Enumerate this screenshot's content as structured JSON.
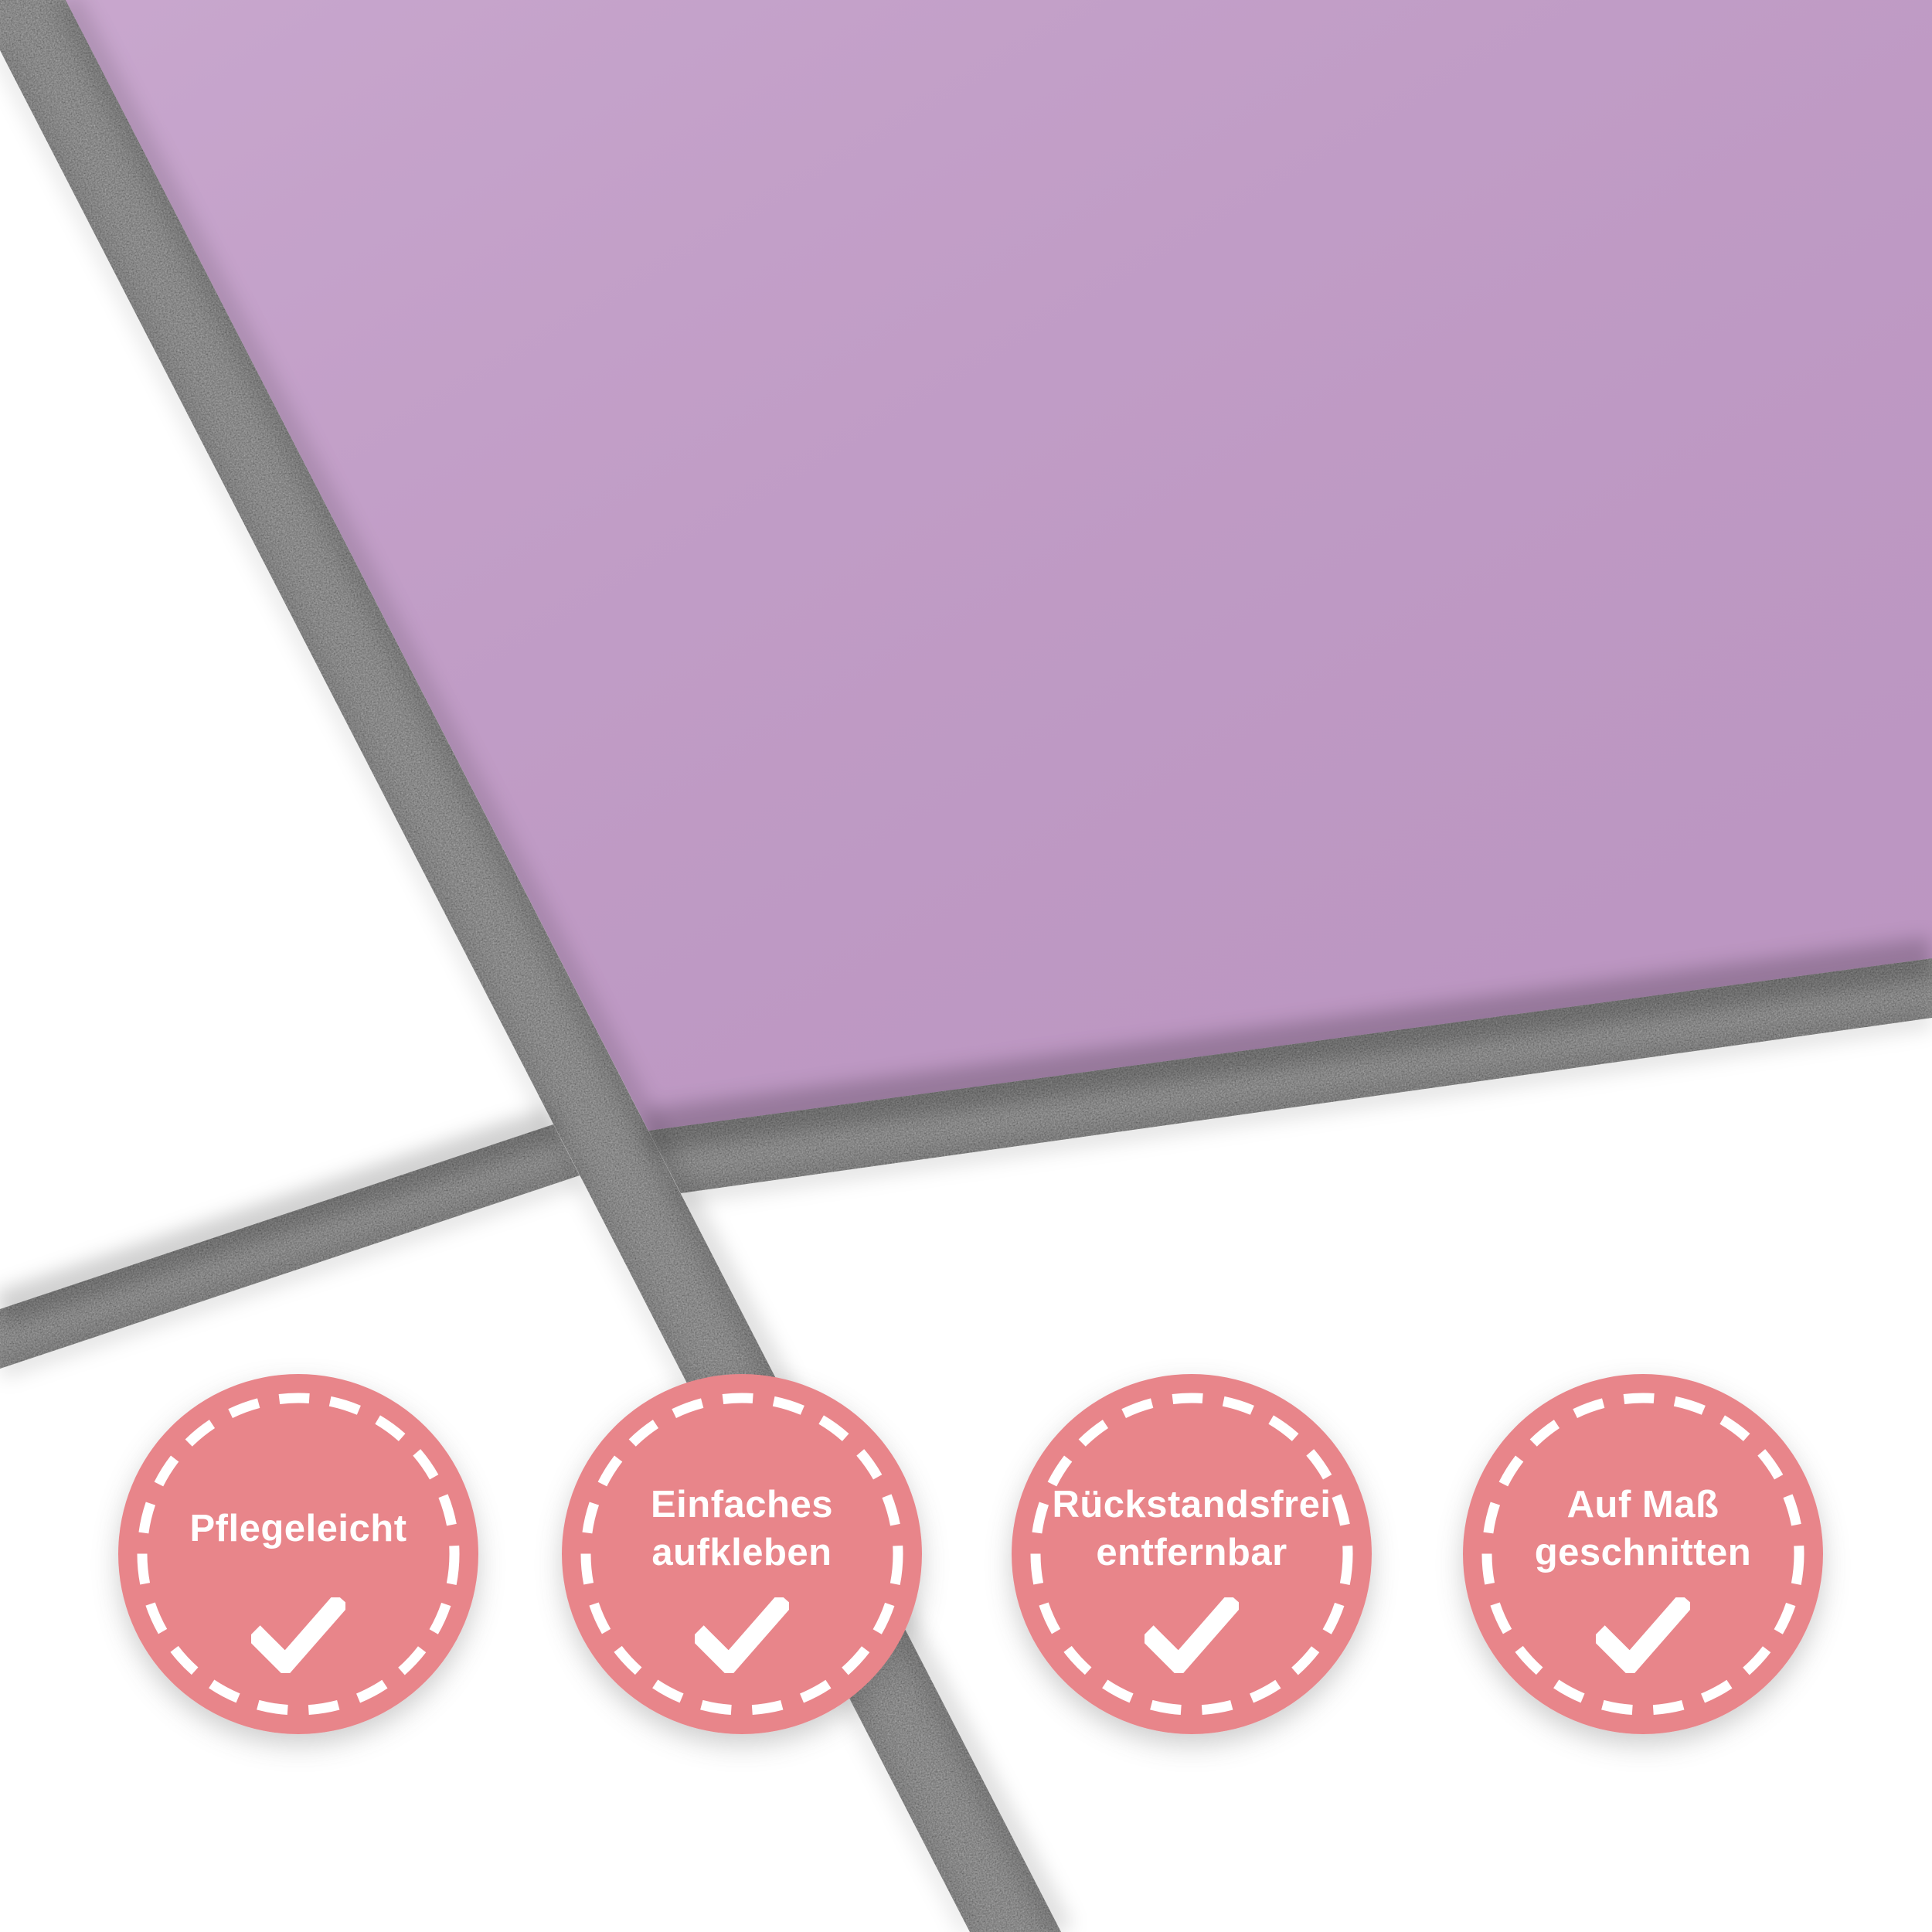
{
  "colors": {
    "tile": "#c29dc8",
    "tile_white": "#ffffff",
    "grout": "#8e8e8e",
    "badge": "#e8858a",
    "badge_border": "#ffffff",
    "badge_text": "#ffffff",
    "badge_check": "#ffffff"
  },
  "badges": [
    {
      "label": "Pflegeleicht",
      "lines": [
        "Pflegeleicht"
      ],
      "icon": "checkmark"
    },
    {
      "label": "Einfaches aufkleben",
      "lines": [
        "Einfaches",
        "aufkleben"
      ],
      "icon": "checkmark"
    },
    {
      "label": "Rückstandsfrei entfernbar",
      "lines": [
        "Rückstandsfrei",
        "entfernbar"
      ],
      "icon": "checkmark"
    },
    {
      "label": "Auf Maß geschnitten",
      "lines": [
        "Auf Maß",
        "geschnitten"
      ],
      "icon": "checkmark"
    }
  ]
}
